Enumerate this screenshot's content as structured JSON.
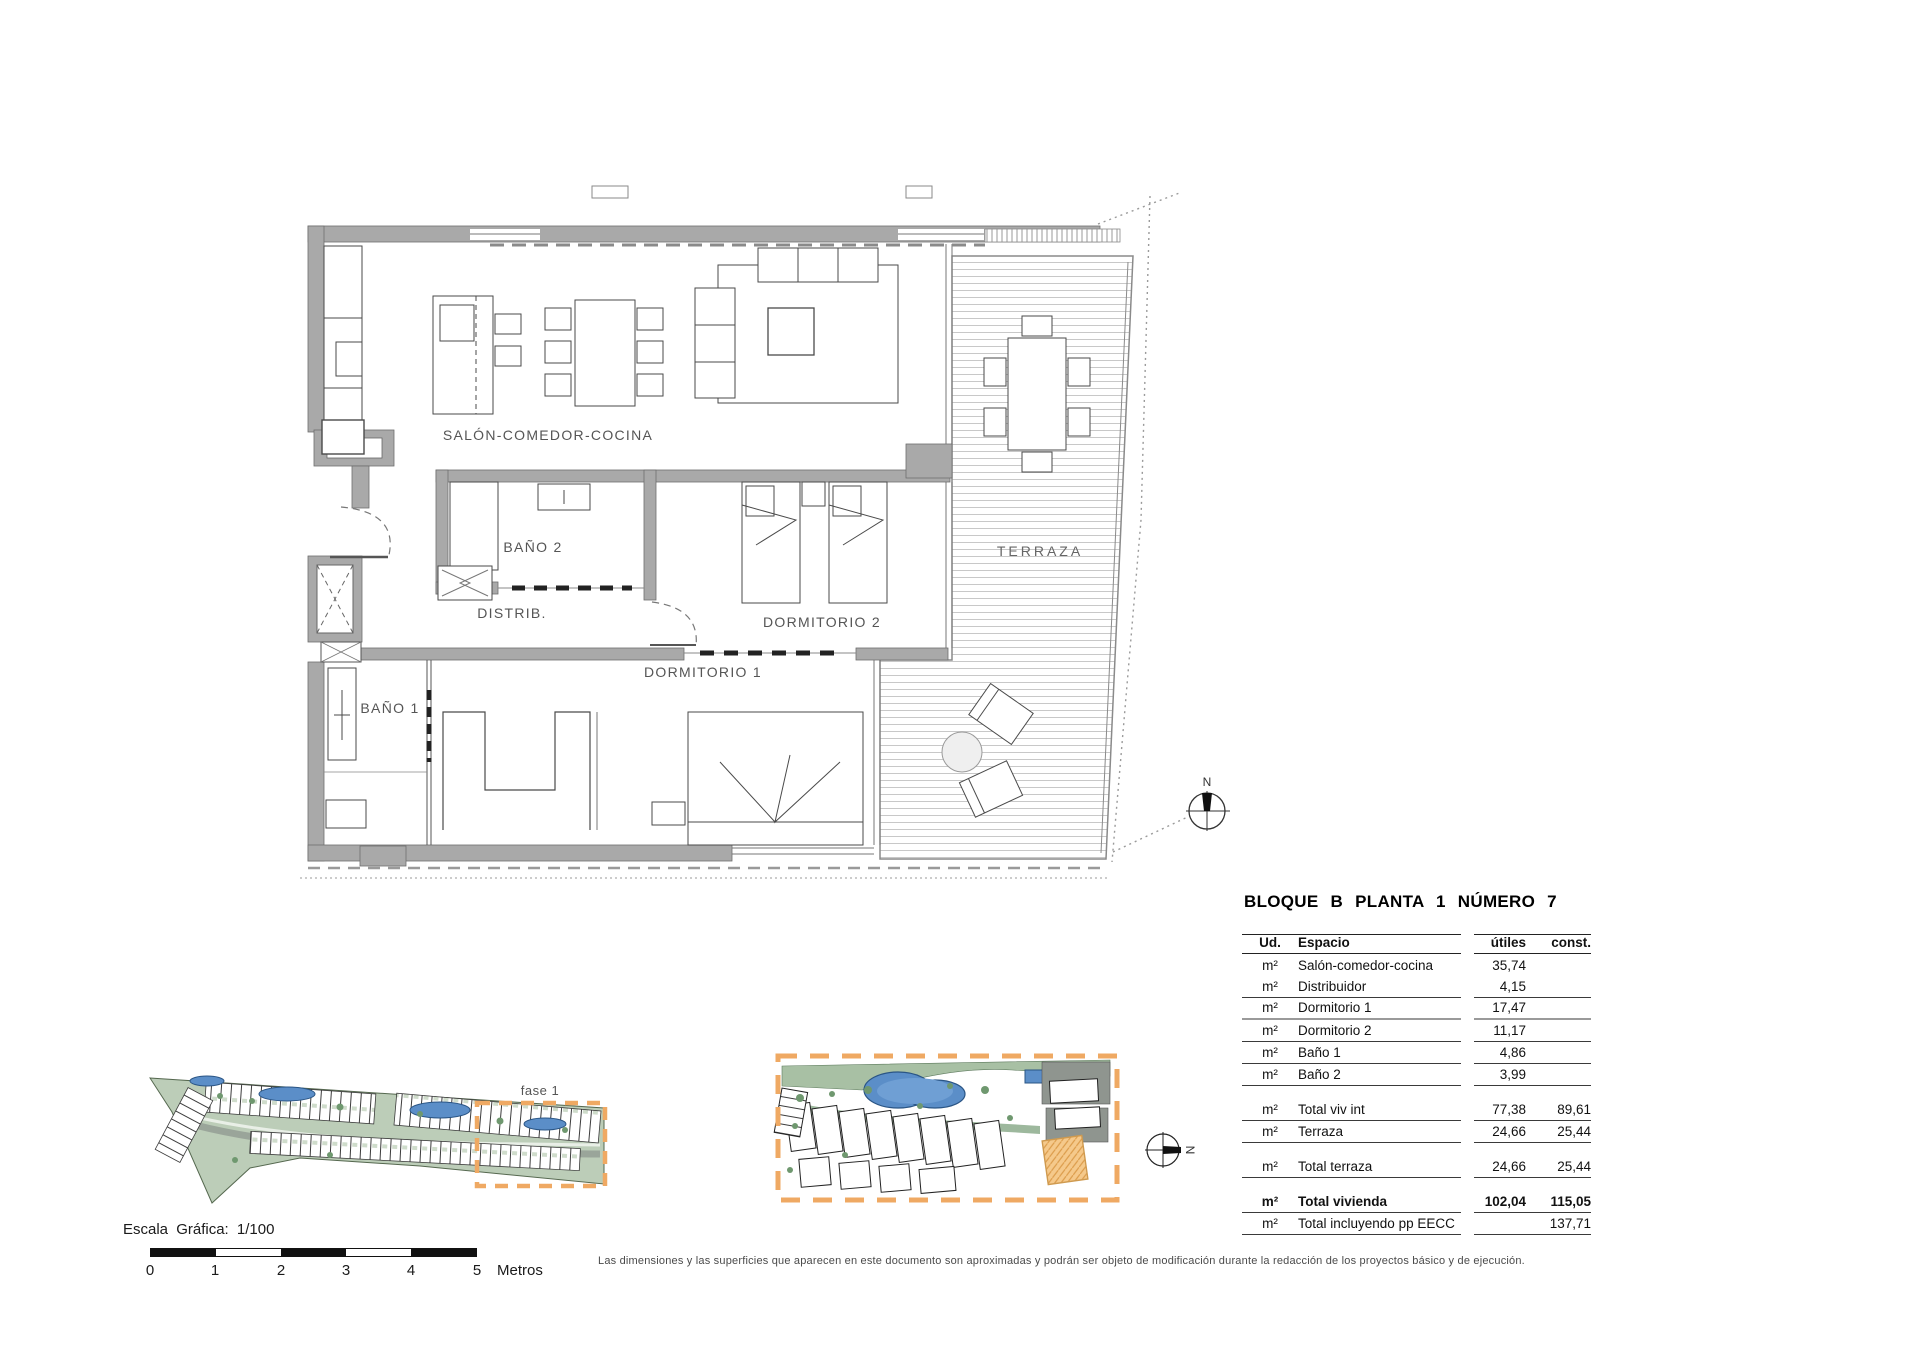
{
  "floor_plan": {
    "rooms": {
      "salon": "SALÓN-COMEDOR-COCINA",
      "bano2": "BAÑO 2",
      "distrib": "DISTRIB.",
      "dormitorio2": "DORMITORIO 2",
      "dormitorio1": "DORMITORIO 1",
      "bano1": "BAÑO 1",
      "terraza": "TERRAZA"
    },
    "north_label": "N"
  },
  "site_plans": {
    "fase_label": "fase 1",
    "north_label": "N"
  },
  "table": {
    "title": "BLOQUE B PLANTA 1 NÚMERO 7",
    "headers": {
      "ud": "Ud.",
      "espacio": "Espacio",
      "utiles": "útiles",
      "const": "const."
    },
    "rows": [
      {
        "ud": "m²",
        "espacio": "Salón-comedor-cocina",
        "utiles": "35,74",
        "const": ""
      },
      {
        "ud": "m²",
        "espacio": "Distribuidor",
        "utiles": "4,15",
        "const": ""
      },
      {
        "ud": "m²",
        "espacio": "Dormitorio 1",
        "utiles": "17,47",
        "const": ""
      },
      {
        "ud": "m²",
        "espacio": "Dormitorio 2",
        "utiles": "11,17",
        "const": ""
      },
      {
        "ud": "m²",
        "espacio": "Baño 1",
        "utiles": "4,86",
        "const": ""
      },
      {
        "ud": "m²",
        "espacio": "Baño 2",
        "utiles": "3,99",
        "const": ""
      },
      {
        "ud": "m²",
        "espacio": "Total viv int",
        "utiles": "77,38",
        "const": "89,61"
      },
      {
        "ud": "m²",
        "espacio": "Terraza",
        "utiles": "24,66",
        "const": "25,44"
      },
      {
        "ud": "m²",
        "espacio": "Total terraza",
        "utiles": "24,66",
        "const": "25,44"
      },
      {
        "ud": "m²",
        "espacio": "Total vivienda",
        "utiles": "102,04",
        "const": "115,05"
      },
      {
        "ud": "m²",
        "espacio": "Total incluyendo pp EECC",
        "utiles": "",
        "const": "137,71"
      }
    ]
  },
  "scale": {
    "label": "Escala Gráfica:  1/100",
    "ticks": [
      "0",
      "1",
      "2",
      "3",
      "4",
      "5"
    ],
    "unit": "Metros"
  },
  "disclaimer": "Las dimensiones y las superficies que aparecen en este documento son aproximadas y podrán ser objeto de modificación durante la redacción de los proyectos básico y de ejecución.",
  "colors": {
    "wall_gray": "#a9a9a9",
    "accent_orange": "#efa963",
    "pool_blue": "#5b8ec8",
    "site_green": "#aec4ab"
  }
}
